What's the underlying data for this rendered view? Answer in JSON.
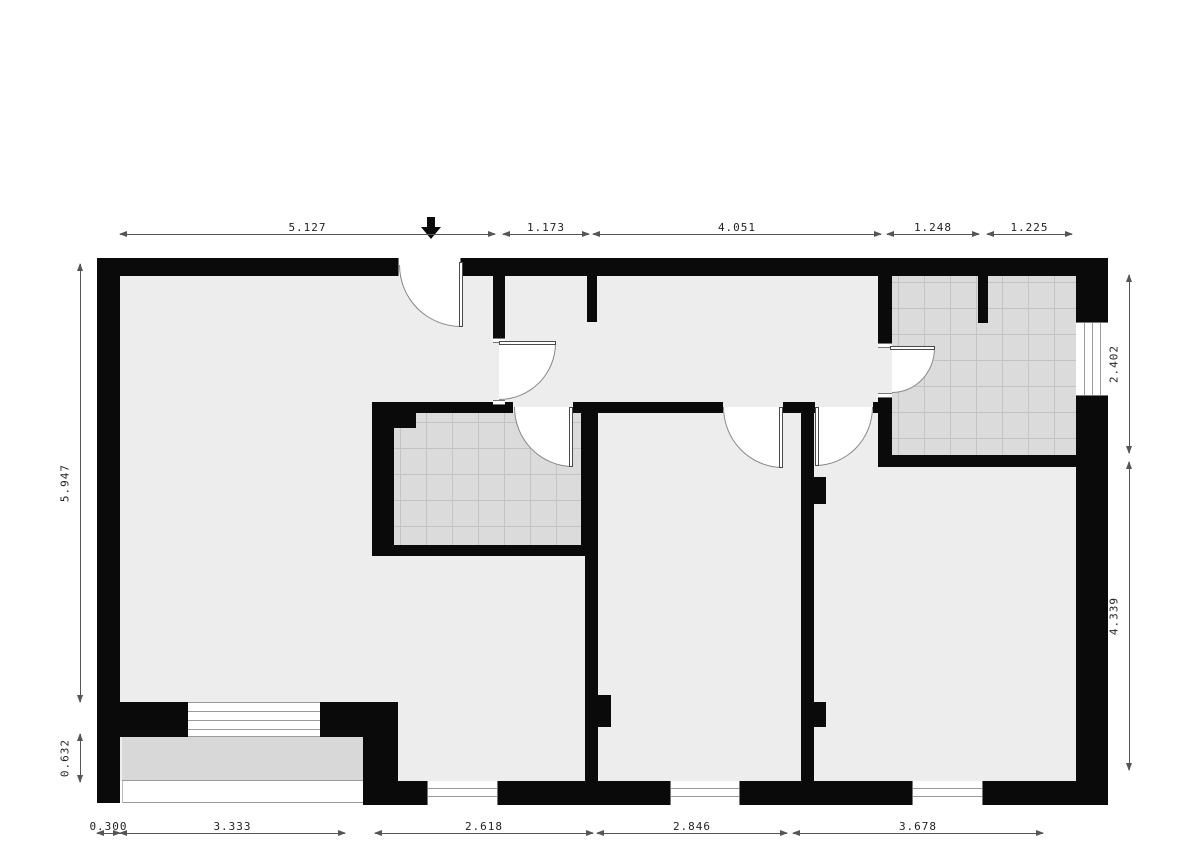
{
  "plan": {
    "type": "architectural-floor-plan",
    "dims_top": [
      "5.127",
      "1.173",
      "4.051",
      "1.248",
      "1.225"
    ],
    "dims_left": [
      "5.947",
      "0.632"
    ],
    "dims_right": [
      "2.402",
      "4.339"
    ],
    "dims_bottom": [
      "0.300",
      "3.333",
      "2.618",
      "2.846",
      "3.678"
    ],
    "icons": {
      "entrance": "entrance-arrow"
    },
    "colors": {
      "wall": "#0a0a0a",
      "floor": "#ededed",
      "tile": "#dbdbdb",
      "tile_line": "#c3c3c3",
      "porch": "#d8d8d8",
      "dim_line": "#555555",
      "text": "#222222"
    }
  }
}
